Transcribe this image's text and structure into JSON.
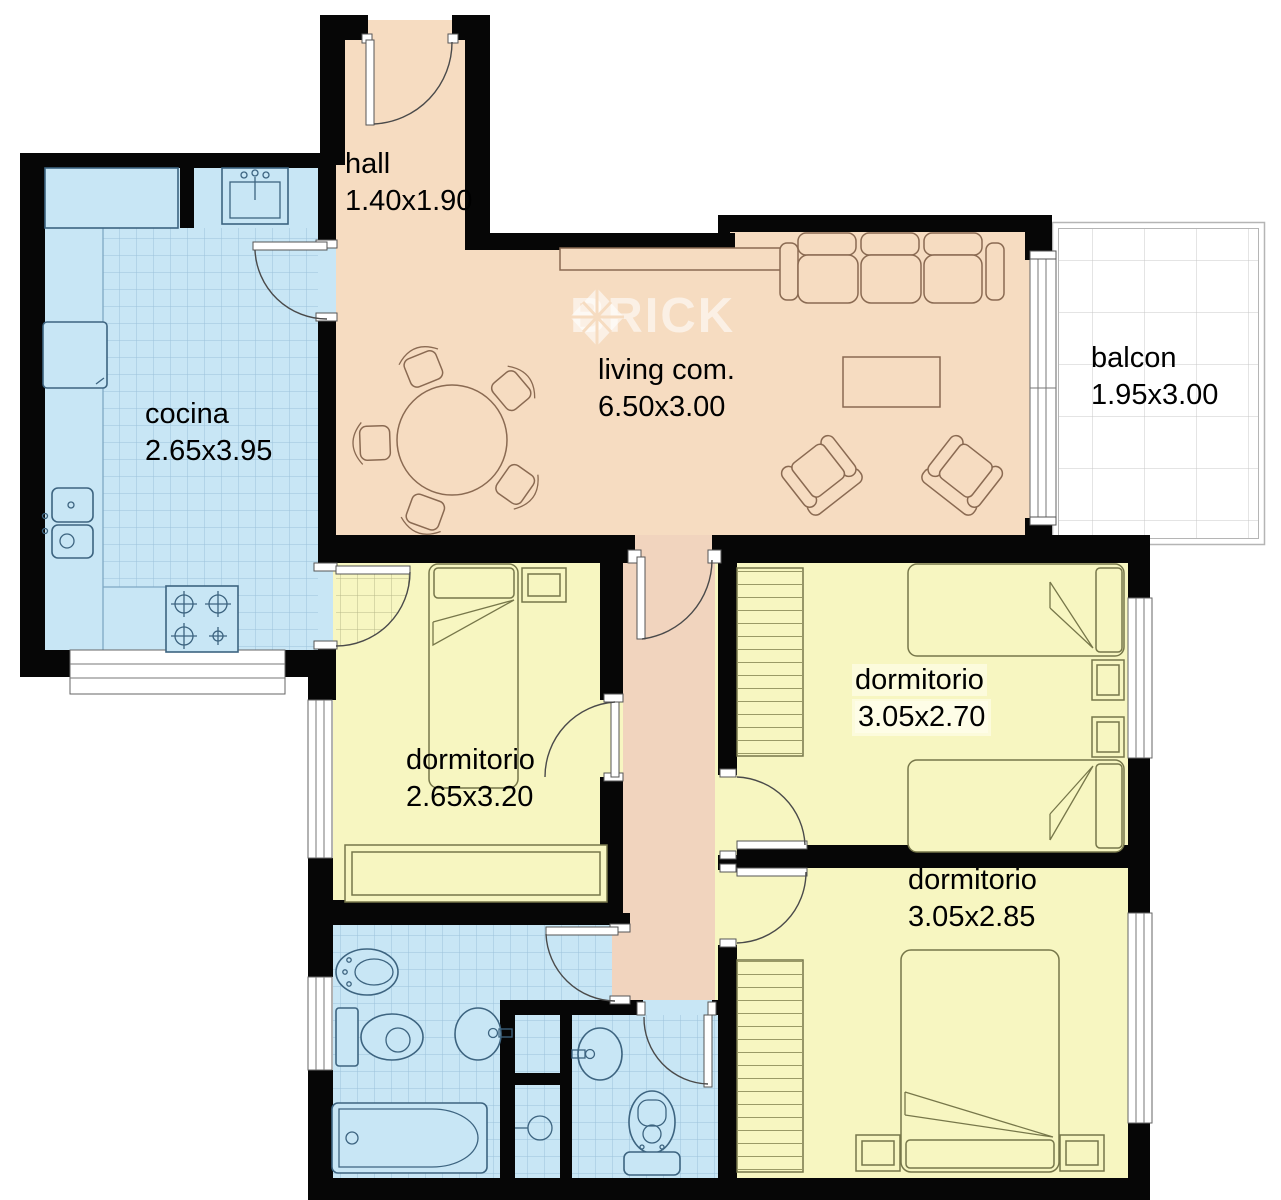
{
  "watermark": {
    "text": "BRICK"
  },
  "rooms": [
    {
      "name": "hall",
      "dimensions": "1.40x1.90"
    },
    {
      "name": "living com.",
      "dimensions": "6.50x3.00"
    },
    {
      "name": "balcon",
      "dimensions": "1.95x3.00"
    },
    {
      "name": "cocina",
      "dimensions": "2.65x3.95"
    },
    {
      "name": "dormitorio",
      "dimensions": "2.65x3.20"
    },
    {
      "name": "dormitorio",
      "dimensions": "3.05x2.70"
    },
    {
      "name": "dormitorio",
      "dimensions": "3.05x2.85"
    }
  ],
  "colors": {
    "wall": "#060606",
    "living": "#F6DCC1",
    "corridor": "#F1D4BE",
    "wet": "#C8E6F5",
    "wet_window": "#D9ECF7",
    "bedroom": "#F7F6C1",
    "balcony": "#FFFFFF",
    "grid_blue": "#9CC2DA",
    "grid_balcony": "#C9C9C9",
    "closet_lines": "#9a9a66",
    "stroke_wet": "#3D6480",
    "stroke_living": "#8A6A52",
    "stroke_bed": "#77774a",
    "stroke_arc": "#4a4a4a",
    "watermark": "rgba(255,255,255,0.58)"
  }
}
